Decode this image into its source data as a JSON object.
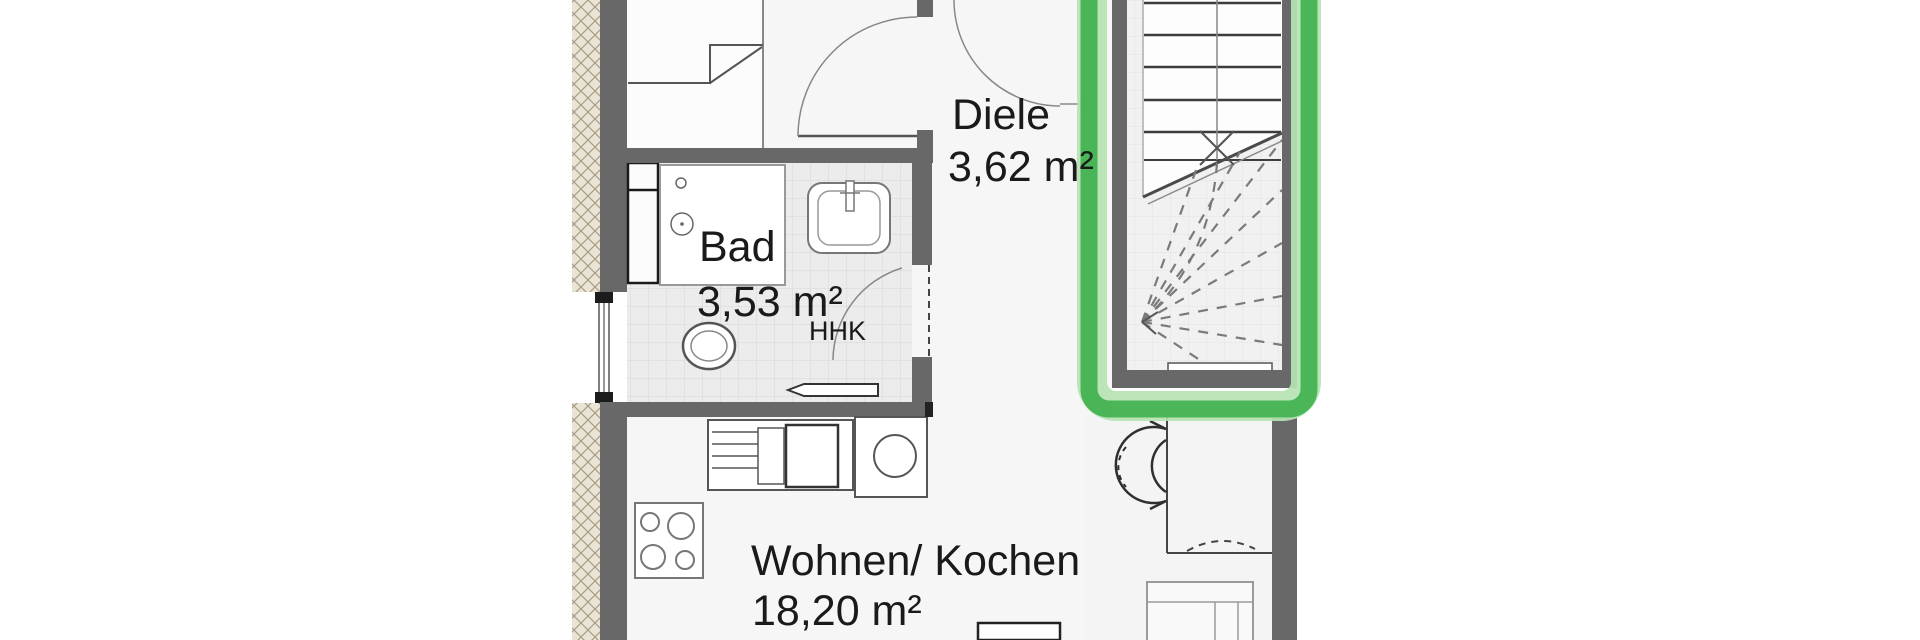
{
  "plan": {
    "title": "apartment-floor-plan",
    "rooms": [
      {
        "id": "diele",
        "label": "Diele",
        "area": "3,62 m²"
      },
      {
        "id": "bad",
        "label": "Bad",
        "area": "3,53 m²"
      },
      {
        "id": "wohnen_kochen",
        "label": "Wohnen/ Kochen",
        "area": "18,20 m²"
      }
    ],
    "labels": {
      "radiator": "HHK"
    },
    "fixtures": [
      "shower",
      "washbasin",
      "toilet",
      "towel-radiator",
      "window",
      "kitchen-counter-sink",
      "kitchen-unit-round-sink",
      "hob-4-rings",
      "staircase-with-winders",
      "entrance-door-swing",
      "room-door-swing",
      "swing-door-symbol",
      "armchair",
      "side-table"
    ],
    "highlight": {
      "target": "staircase",
      "color": "#3bb04a",
      "color_light": "#b7e3b4"
    },
    "colors": {
      "wall_gray": "#686868",
      "insulation_beige": "#e9e4d6",
      "insulation_hatch": "#a79d82",
      "tile_fill": "#ececec",
      "tile_line": "#d6d6d6",
      "line_dark": "#3d3d3d",
      "text": "#1a1a1a"
    }
  }
}
